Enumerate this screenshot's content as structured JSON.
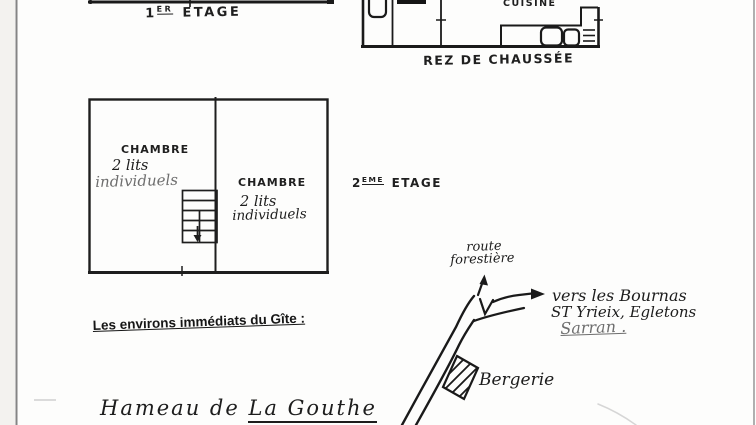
{
  "document": {
    "floor_first": {
      "num": "1",
      "sup": "ER",
      "word": "ETAGE"
    },
    "ground": {
      "kitchen": "CUISINE",
      "caption": "REZ DE CHAUSSÉE"
    },
    "floor_second": {
      "num": "2",
      "sup": "EME",
      "word": "ETAGE",
      "left_room": {
        "name": "CHAMBRE",
        "beds_line1": "2 lits",
        "beds_line2": "individuels"
      },
      "right_room": {
        "name": "CHAMBRE",
        "beds_line1": "2 lits",
        "beds_line2": "individuels"
      }
    },
    "surroundings_heading": "Les environs immédiats du Gîte :",
    "map": {
      "route_line1": "route",
      "route_line2": "forestière",
      "dest_line1": "vers les Bournas",
      "dest_line2": "ST Yrieix, Egletons",
      "dest_line3": "Sarran .",
      "building_label": "Bergerie"
    },
    "hamlet": {
      "prefix": "Hameau de",
      "name": "La Gouthe"
    }
  },
  "colors": {
    "ink": "#1b1b1b",
    "pencil_gray": "#6e6e6e",
    "scan_border": "#8e8e8e"
  }
}
